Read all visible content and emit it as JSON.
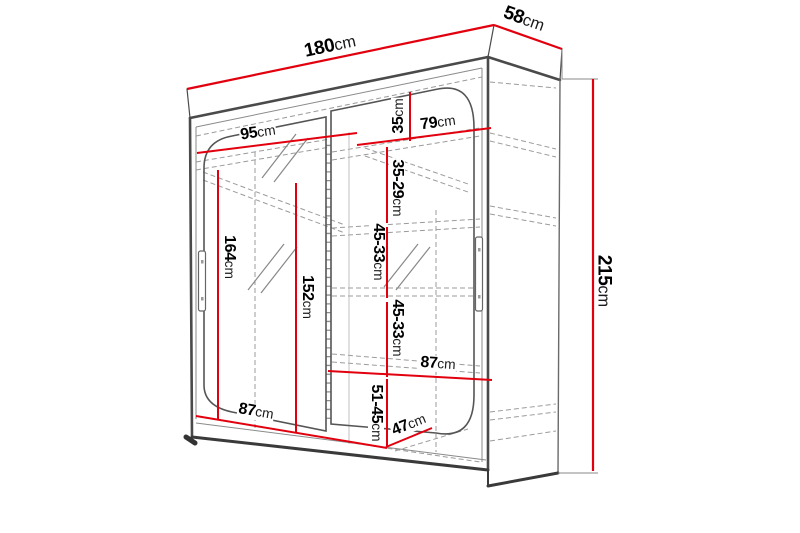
{
  "diagram": {
    "subject": "wardrobe-dimension-drawing",
    "colors": {
      "dimension_line": "#e2000e",
      "outline": "#4a4a4a",
      "hidden_line": "#9b9b9b",
      "text": "#000000",
      "background": "#ffffff"
    },
    "labels": [
      {
        "name": "total-width",
        "value": "180",
        "unit": "cm"
      },
      {
        "name": "depth",
        "value": "58",
        "unit": "cm"
      },
      {
        "name": "total-height",
        "value": "215",
        "unit": "cm"
      },
      {
        "name": "left-section-width",
        "value": "95",
        "unit": "cm"
      },
      {
        "name": "top-shelf-gap",
        "value": "35",
        "unit": "cm"
      },
      {
        "name": "right-section-width",
        "value": "79",
        "unit": "cm"
      },
      {
        "name": "shelf-gap-35-29",
        "value": "35-29",
        "unit": "cm"
      },
      {
        "name": "shelf-gap-45-33-a",
        "value": "45-33",
        "unit": "cm"
      },
      {
        "name": "shelf-gap-45-33-b",
        "value": "45-33",
        "unit": "cm"
      },
      {
        "name": "left-inner-height",
        "value": "164",
        "unit": "cm"
      },
      {
        "name": "mirror-height",
        "value": "152",
        "unit": "cm"
      },
      {
        "name": "right-shelf-width",
        "value": "87",
        "unit": "cm"
      },
      {
        "name": "left-bottom-width",
        "value": "87",
        "unit": "cm"
      },
      {
        "name": "bottom-gap-51-45",
        "value": "51-45",
        "unit": "cm"
      },
      {
        "name": "bottom-depth",
        "value": "47",
        "unit": "cm"
      }
    ]
  }
}
